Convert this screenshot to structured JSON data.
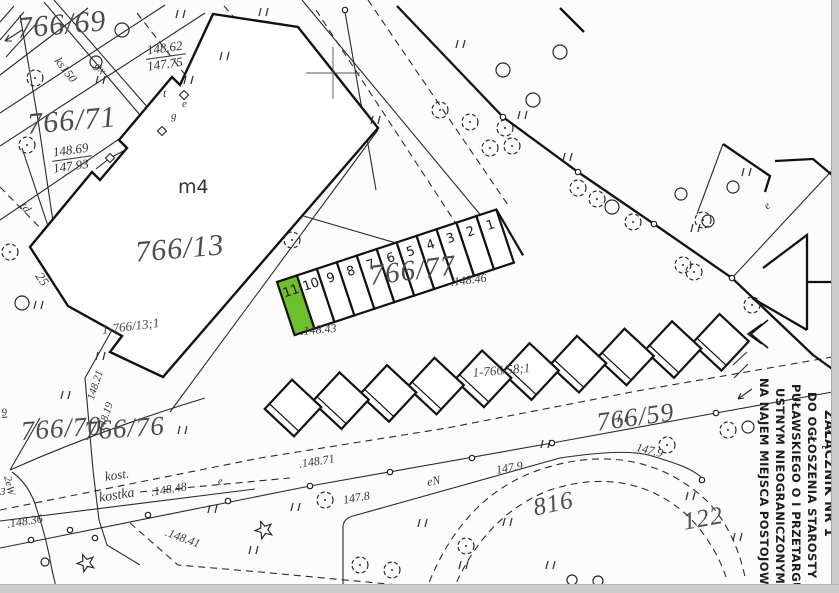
{
  "document": {
    "type": "cadastral-map-scan",
    "highlight_color": "#6ebe2d",
    "ink_color": "#1c1c1c"
  },
  "note": {
    "lines": [
      "ZAŁĄCZNIK NR 1",
      "DO OGŁOSZENIA STAROSTY",
      "PUŁAWSKIEGO O I PRZETARGU",
      "USTNYM NIEOGRANICZONYM",
      "NA NAJEM MIEJSCA POSTOJOWEGO"
    ]
  },
  "stalls": {
    "parcel_label": "766/77",
    "numbers": [
      "11",
      "10",
      "9",
      "8",
      "7",
      "6",
      "5",
      "4",
      "3",
      "2",
      "1"
    ],
    "highlight_index": 0,
    "origin": [
      277,
      282
    ],
    "angle": -18.3,
    "w": 21,
    "h": 56
  },
  "garages": {
    "label": "1-766/58;1",
    "count": 10,
    "start": [
      293,
      408
    ],
    "dx": 47.5,
    "dy": -7.3,
    "side": 40,
    "tilt": -47
  },
  "labels": [
    {
      "t": "766/69",
      "x": 16,
      "y": 14,
      "s": 30,
      "r": -5,
      "c": "p"
    },
    {
      "t": "766/71",
      "x": 26,
      "y": 110,
      "s": 30,
      "r": -5,
      "c": "p"
    },
    {
      "t": "766/13",
      "x": 134,
      "y": 238,
      "s": 30,
      "r": -5,
      "c": "p"
    },
    {
      "t": "766/77",
      "x": 368,
      "y": 262,
      "s": 29,
      "r": -7,
      "c": "p"
    },
    {
      "t": "766/70",
      "x": 20,
      "y": 418,
      "s": 27,
      "r": -4,
      "c": "p"
    },
    {
      "t": "766/76",
      "x": 83,
      "y": 418,
      "s": 27,
      "r": -4,
      "c": "p"
    },
    {
      "t": "766/59",
      "x": 595,
      "y": 410,
      "s": 26,
      "r": -8,
      "c": "p"
    },
    {
      "t": "816",
      "x": 531,
      "y": 496,
      "s": 25,
      "r": -12,
      "c": "p"
    },
    {
      "t": "122",
      "x": 681,
      "y": 510,
      "s": 25,
      "r": -10,
      "c": "p"
    },
    {
      "t": "1-766/58;1",
      "x": 472,
      "y": 366,
      "s": 13,
      "r": -5,
      "c": "ps"
    },
    {
      "t": "1-766/13;1",
      "x": 101,
      "y": 323,
      "s": 13,
      "r": -7,
      "c": "ps"
    },
    {
      "t": "m4",
      "x": 178,
      "y": 178,
      "s": 19,
      "r": 0,
      "c": "plain"
    },
    {
      "t": "ks150",
      "x": 62,
      "y": 55,
      "s": 12,
      "r": 52,
      "c": "tech"
    },
    {
      "t": "gx",
      "x": 102,
      "y": 60,
      "s": 12,
      "r": 52,
      "c": "tech"
    },
    {
      "t": "t",
      "x": 163,
      "y": 87,
      "s": 12,
      "r": 0,
      "c": "e"
    },
    {
      "t": "e",
      "x": 182,
      "y": 99,
      "s": 11,
      "r": 0,
      "c": "e"
    },
    {
      "t": "g",
      "x": 171,
      "y": 111,
      "s": 11,
      "r": 0,
      "c": "e"
    },
    {
      "t": "td",
      "x": 28,
      "y": 200,
      "s": 12,
      "r": 55,
      "c": "tech"
    },
    {
      "t": "25",
      "x": 44,
      "y": 270,
      "s": 13,
      "r": 55,
      "c": "tech"
    },
    {
      "t": "9",
      "x": 1,
      "y": 408,
      "s": 11,
      "r": -5,
      "c": "e u"
    },
    {
      "t": "3",
      "x": 0,
      "y": 487,
      "s": 11,
      "r": 0,
      "c": "e"
    },
    {
      "t": "148.21",
      "x": 86,
      "y": 398,
      "s": 11,
      "r": -72,
      "c": "e"
    },
    {
      "t": "148.19",
      "x": 96,
      "y": 430,
      "s": 11,
      "r": -72,
      "c": "e"
    },
    {
      "t": "2eW",
      "x": 12,
      "y": 475,
      "s": 11,
      "r": 78,
      "c": "tech"
    },
    {
      "t": "kost.",
      "x": 104,
      "y": 470,
      "s": 13,
      "r": -8,
      "c": "e"
    },
    {
      "t": "kostka",
      "x": 98,
      "y": 492,
      "s": 14,
      "r": -9,
      "c": "e"
    },
    {
      "t": ".148.48",
      "x": 150,
      "y": 486,
      "s": 12,
      "r": -9,
      "c": "e"
    },
    {
      "t": ".148.36",
      "x": 6,
      "y": 518,
      "s": 12,
      "r": -9,
      "c": "e"
    },
    {
      "t": ".148.41",
      "x": 168,
      "y": 526,
      "s": 12,
      "r": 20,
      "c": "e"
    },
    {
      "t": "e",
      "x": 217,
      "y": 477,
      "s": 11,
      "r": -9,
      "c": "e"
    },
    {
      "t": ".148.71",
      "x": 298,
      "y": 458,
      "s": 12,
      "r": -9,
      "c": "e"
    },
    {
      "t": "147.8",
      "x": 342,
      "y": 494,
      "s": 12,
      "r": -10,
      "c": "e"
    },
    {
      "t": "eN",
      "x": 426,
      "y": 476,
      "s": 12,
      "r": -10,
      "c": "e"
    },
    {
      "t": "147.9",
      "x": 495,
      "y": 464,
      "s": 12,
      "r": -10,
      "c": "e"
    },
    {
      "t": "147.9",
      "x": 638,
      "y": 441,
      "s": 12,
      "r": 14,
      "c": "e"
    },
    {
      "t": ".148.46",
      "x": 450,
      "y": 276,
      "s": 12,
      "r": -7,
      "c": "e"
    },
    {
      "t": ".148.43",
      "x": 300,
      "y": 325,
      "s": 12,
      "r": -5,
      "c": "e"
    },
    {
      "t": "e",
      "x": 762,
      "y": 204,
      "s": 11,
      "r": -43,
      "c": "e"
    }
  ],
  "fractions": [
    {
      "top": "148.62",
      "bot": "147.75",
      "x": 144,
      "y": 44,
      "r": -8
    },
    {
      "top": "148.69",
      "bot": "147.93",
      "x": 50,
      "y": 146,
      "r": -8
    }
  ],
  "symbols": {
    "trees": [
      [
        35,
        78
      ],
      [
        27,
        145
      ],
      [
        10,
        252
      ],
      [
        292,
        240
      ],
      [
        440,
        110
      ],
      [
        470,
        122
      ],
      [
        505,
        128
      ],
      [
        512,
        146
      ],
      [
        490,
        148
      ],
      [
        578,
        188
      ],
      [
        597,
        199
      ],
      [
        633,
        222
      ],
      [
        703,
        220
      ],
      [
        683,
        265
      ],
      [
        694,
        272
      ],
      [
        752,
        305
      ],
      [
        325,
        500
      ],
      [
        360,
        565
      ],
      [
        392,
        570
      ],
      [
        466,
        546
      ],
      [
        728,
        430
      ],
      [
        667,
        445
      ]
    ],
    "conifers": [
      [
        122,
        30,
        7
      ],
      [
        96,
        62,
        6
      ],
      [
        22,
        303,
        7
      ],
      [
        503,
        70,
        7
      ],
      [
        560,
        52,
        7
      ],
      [
        533,
        100,
        7
      ],
      [
        612,
        207,
        7
      ],
      [
        733,
        187,
        6
      ],
      [
        681,
        194,
        6
      ],
      [
        708,
        221,
        6
      ],
      [
        748,
        427,
        6
      ],
      [
        45,
        562,
        4
      ],
      [
        572,
        580,
        5
      ],
      [
        598,
        581,
        5
      ]
    ],
    "grass": [
      [
        180,
        14
      ],
      [
        263,
        12
      ],
      [
        224,
        56
      ],
      [
        188,
        80
      ],
      [
        100,
        80
      ],
      [
        375,
        120
      ],
      [
        460,
        44
      ],
      [
        522,
        115
      ],
      [
        567,
        157
      ],
      [
        746,
        172
      ],
      [
        695,
        228
      ],
      [
        38,
        305
      ],
      [
        100,
        356
      ],
      [
        65,
        395
      ],
      [
        182,
        430
      ],
      [
        212,
        509
      ],
      [
        295,
        507
      ],
      [
        253,
        550
      ],
      [
        422,
        523
      ],
      [
        507,
        522
      ],
      [
        463,
        565
      ],
      [
        622,
        418
      ],
      [
        690,
        496
      ],
      [
        737,
        537
      ],
      [
        550,
        565
      ],
      [
        545,
        444
      ]
    ],
    "stars": [
      [
        86,
        563
      ],
      [
        264,
        530
      ]
    ],
    "nodes": [
      [
        503,
        117
      ],
      [
        578,
        172
      ],
      [
        654,
        224
      ],
      [
        732,
        278
      ],
      [
        31,
        540
      ],
      [
        70,
        530
      ],
      [
        148,
        515
      ],
      [
        228,
        501
      ],
      [
        310,
        486
      ],
      [
        390,
        472
      ],
      [
        472,
        458
      ],
      [
        552,
        443
      ],
      [
        716,
        413
      ],
      [
        345,
        10
      ],
      [
        702,
        480
      ],
      [
        95,
        538
      ]
    ],
    "squares": [
      [
        184,
        95
      ],
      [
        162,
        131
      ],
      [
        110,
        158
      ]
    ],
    "crosses": [
      [
        333,
        73
      ]
    ]
  }
}
